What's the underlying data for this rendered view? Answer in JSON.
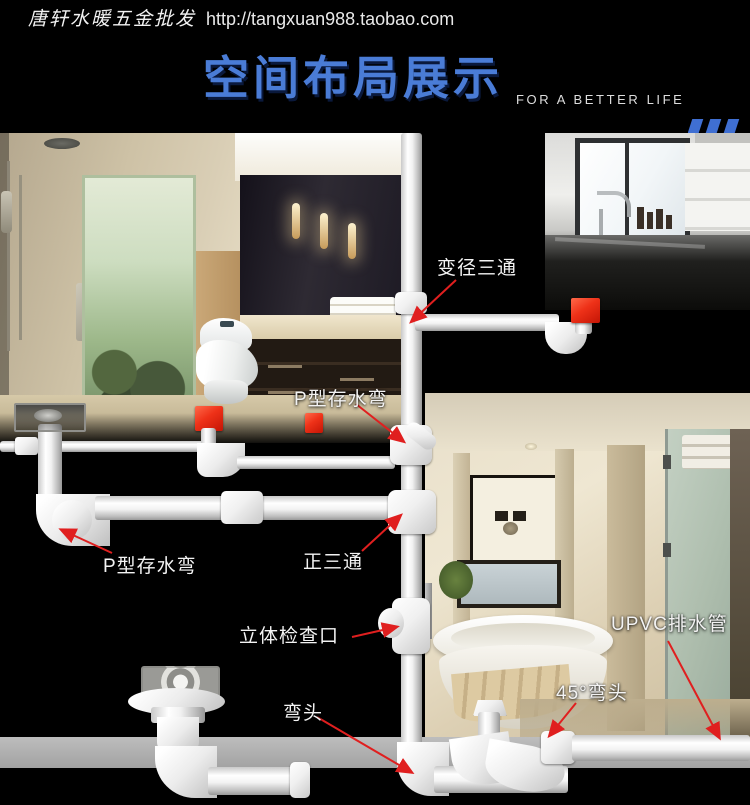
{
  "header": {
    "brand": "唐轩水暖五金批发",
    "url": "http://tangxuan988.taobao.com"
  },
  "banner": {
    "title": "空间布局展示",
    "tagline": "FOR A BETTER LIFE"
  },
  "labels": [
    {
      "id": "reducing-tee",
      "text": "变径三通"
    },
    {
      "id": "p-trap-upper",
      "text": "P型存水弯"
    },
    {
      "id": "p-trap-lower",
      "text": "P型存水弯"
    },
    {
      "id": "straight-tee",
      "text": "正三通"
    },
    {
      "id": "inspection-port",
      "text": "立体检查口"
    },
    {
      "id": "upvc-drain-pipe",
      "text": "UPVC排水管"
    },
    {
      "id": "elbow-45",
      "text": "45°弯头"
    },
    {
      "id": "elbow",
      "text": "弯头"
    }
  ],
  "colors": {
    "background": "#000000",
    "title_blue": "#4a7cd6",
    "accent_red": "#e82b17",
    "arrow_red": "#e01f1f",
    "pipe_white": "#ffffff",
    "floor_gray": "#acacac"
  }
}
